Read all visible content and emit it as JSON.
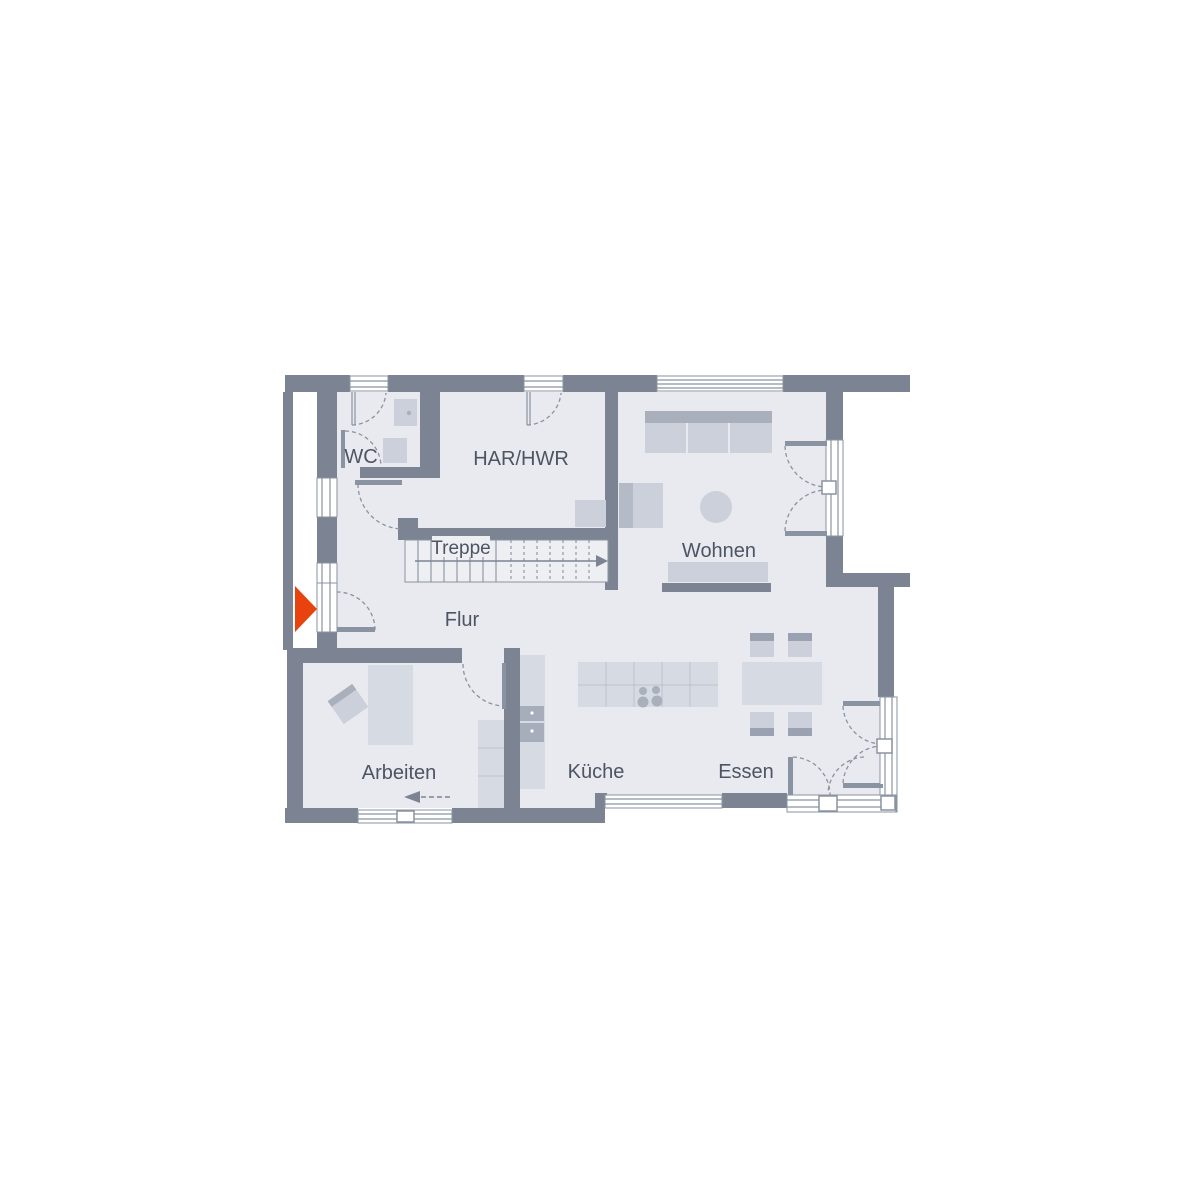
{
  "rooms": {
    "wc": {
      "label": "WC"
    },
    "har_hwr": {
      "label": "HAR/HWR"
    },
    "treppe": {
      "label": "Treppe"
    },
    "wohnen": {
      "label": "Wohnen"
    },
    "flur": {
      "label": "Flur"
    },
    "arbeiten": {
      "label": "Arbeiten"
    },
    "kueche": {
      "label": "Küche"
    },
    "essen": {
      "label": "Essen"
    }
  },
  "entrance": {
    "symbol": "right-pointing-triangle",
    "meaning": "entrance"
  },
  "stairs": {
    "direction": "up-to-right"
  },
  "colors": {
    "wall": "#7c8494",
    "floor": "#e8eaef",
    "line": "#8a93a1",
    "furn": "#d6dae2",
    "furn-mid": "#cbd0da",
    "furn-dark": "#a9b0bc",
    "accent": "#e8430f",
    "ink": "#4d5463"
  }
}
